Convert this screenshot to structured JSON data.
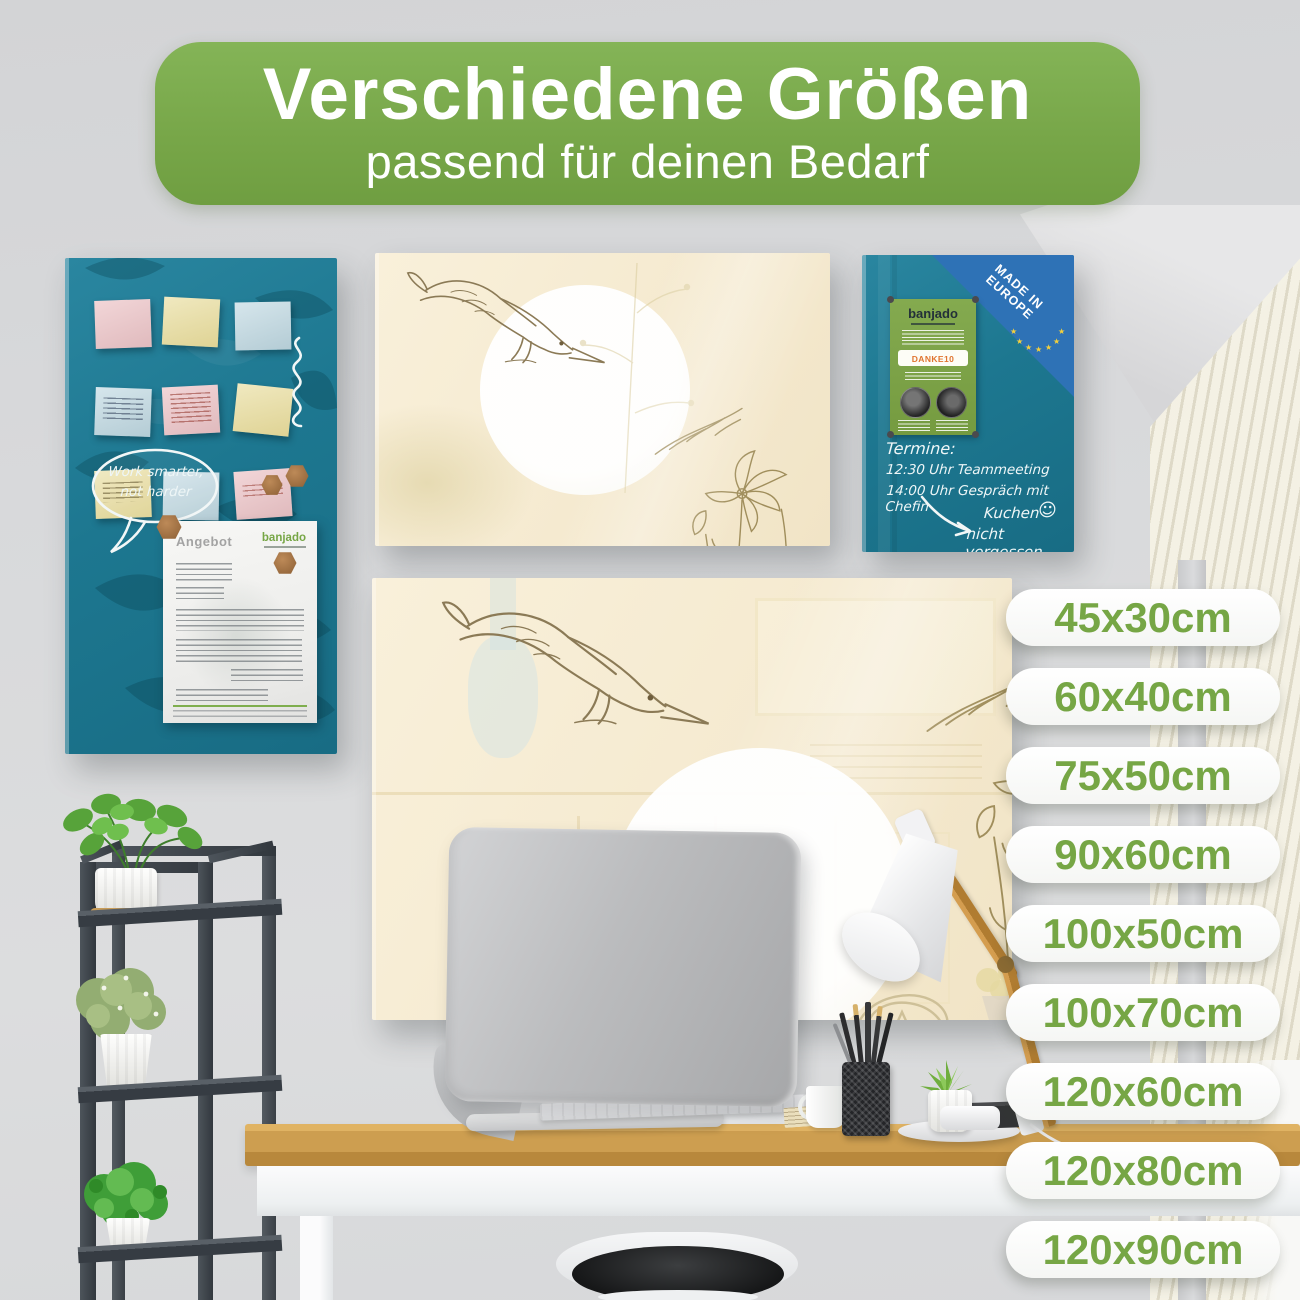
{
  "banner": {
    "title": "Verschiedene Größen",
    "subtitle": "passend für deinen Bedarf"
  },
  "size_badges": [
    "45x30cm",
    "60x40cm",
    "75x50cm",
    "90x60cm",
    "100x50cm",
    "100x70cm",
    "120x60cm",
    "120x80cm",
    "120x90cm"
  ],
  "teal_board": {
    "speech_bubble": {
      "line1": "Work smarter,",
      "line2": "not harder"
    },
    "document": {
      "title": "Angebot",
      "brand": "banjado"
    }
  },
  "small_board": {
    "made_in_badge": {
      "line1": "MADE IN",
      "line2": "EUROPE",
      "star": "★"
    },
    "flyer": {
      "brand": "banjado",
      "coupon": "DANKE10"
    },
    "notes": {
      "heading": "Termine:",
      "line1": "12:30 Uhr Teammeeting",
      "line2": "14:00 Uhr Gespräch mit Chefin",
      "reminder_line1": "Kuchen",
      "reminder_line2": "nicht vergessen",
      "smiley": "☺"
    }
  },
  "colors": {
    "banner_green": "#77a648",
    "badge_text_green": "#76a645",
    "board_teal": "#1d7790",
    "board_cream": "#f5ead0",
    "eu_blue": "#2e72b6",
    "desk_wood": "#c99a4c"
  }
}
